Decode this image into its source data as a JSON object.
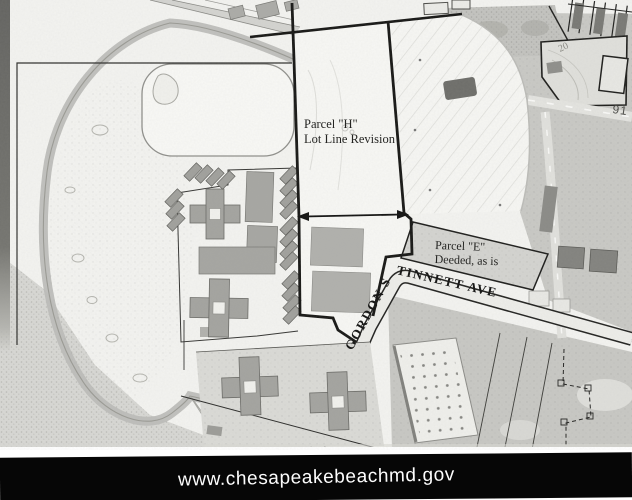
{
  "map": {
    "type": "aerial-parcel-map",
    "labels": {
      "parcel_h_line1": "Parcel \"H\"",
      "parcel_h_line2": "Lot Line Revision",
      "parcel_e_line1": "Parcel \"E\"",
      "parcel_e_line2": "Deeded, as is",
      "street_name_upper": "GORDON S",
      "street_name_lower": "TINNETT AVE",
      "street_name_full": "GORDON STINNETT AVE",
      "route_label": "91",
      "lot_label": "20"
    },
    "colors": {
      "boundary": "#141414",
      "photo_paper": "#f4f4f1",
      "footer_bg": "#060606",
      "footer_text": "#fdfdfd"
    }
  },
  "footer": {
    "url": "www.chesapeakebeachmd.gov"
  }
}
